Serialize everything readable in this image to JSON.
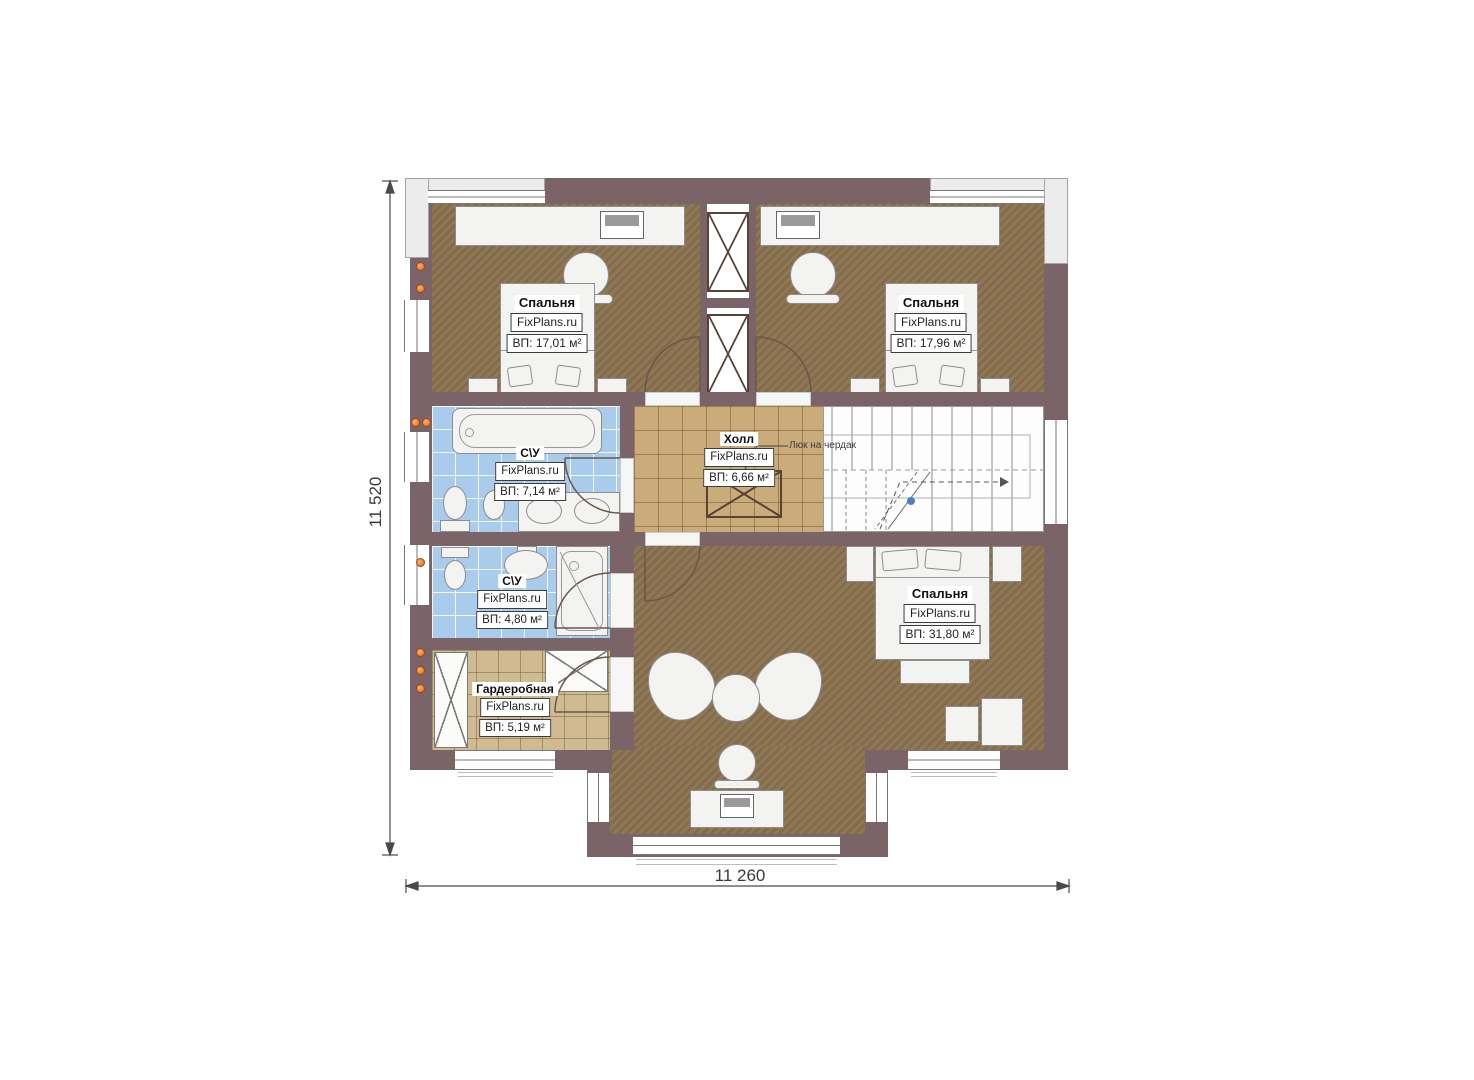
{
  "plan": {
    "brand": "FixPlans.ru",
    "dimensions": {
      "height_label": "11 520",
      "width_label": "11 260"
    },
    "annotations": {
      "attic_hatch_label": "Люк на чердак"
    },
    "rooms": [
      {
        "id": "bedroom-top-left",
        "name": "Спальня",
        "brand": "FixPlans.ru",
        "area": "ВП: 17,01 м²"
      },
      {
        "id": "bedroom-top-right",
        "name": "Спальня",
        "brand": "FixPlans.ru",
        "area": "ВП: 17,96 м²"
      },
      {
        "id": "bathroom-upper",
        "name": "С\\У",
        "brand": "FixPlans.ru",
        "area": "ВП: 7,14 м²"
      },
      {
        "id": "hall",
        "name": "Холл",
        "brand": "FixPlans.ru",
        "area": "ВП: 6,66 м²"
      },
      {
        "id": "bathroom-lower",
        "name": "С\\У",
        "brand": "FixPlans.ru",
        "area": "ВП: 4,80 м²"
      },
      {
        "id": "wardrobe",
        "name": "Гардеробная",
        "brand": "FixPlans.ru",
        "area": "ВП: 5,19 м²"
      },
      {
        "id": "bedroom-master",
        "name": "Спальня",
        "brand": "FixPlans.ru",
        "area": "ВП: 31,80 м²"
      }
    ],
    "colors": {
      "wall": "#7b6467",
      "bedroom_floor": "#8b7350",
      "hall_floor": "#c9ac79",
      "bath_floor": "#a9cbec",
      "wardrobe_floor": "#cfba92",
      "vent_dot": "#e06a1f",
      "stair_marker": "#4a7fc1"
    }
  }
}
